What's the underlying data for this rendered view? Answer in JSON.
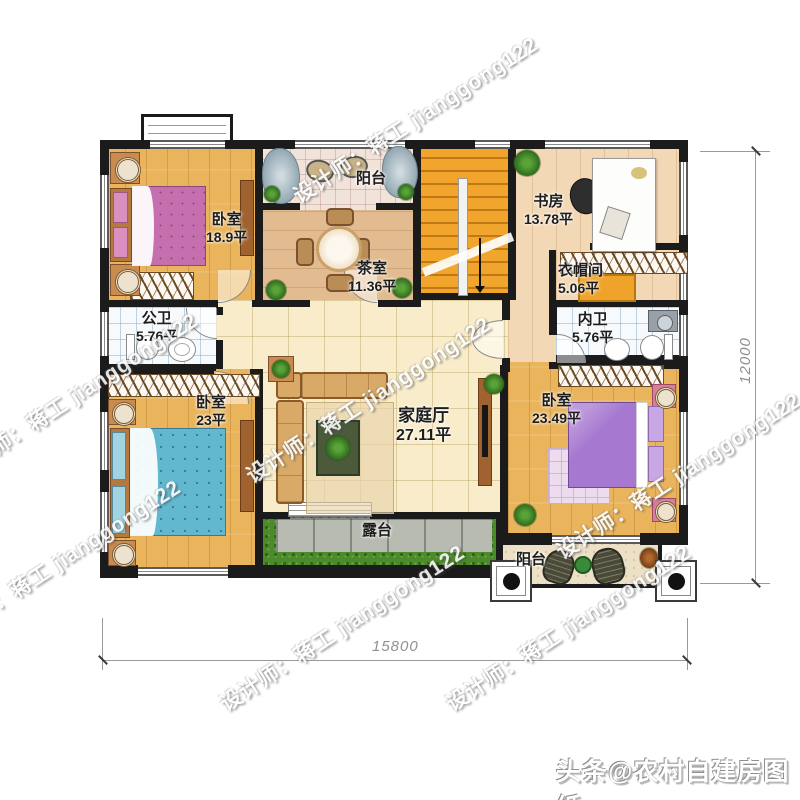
{
  "watermark": {
    "text": "设计师：蒋工 jianggong122"
  },
  "credit": {
    "text": "头条@农村自建房图纸"
  },
  "dimensions": {
    "width_label": "15800",
    "height_label": "12000"
  },
  "rooms": {
    "bedroom1": {
      "name": "卧室",
      "area": "18.9平"
    },
    "balcony_top": {
      "name": "阳台"
    },
    "tea_room": {
      "name": "茶室",
      "area": "11.36平"
    },
    "study": {
      "name": "书房",
      "area": "13.78平"
    },
    "cloakroom": {
      "name": "衣帽间",
      "area": "5.06平"
    },
    "bath_public": {
      "name": "公卫",
      "area": "5.76平"
    },
    "bath_private": {
      "name": "内卫",
      "area": "5.76平"
    },
    "bedroom2": {
      "name": "卧室",
      "area": "23平"
    },
    "family_hall": {
      "name": "家庭厅",
      "area": "27.11平"
    },
    "bedroom3": {
      "name": "卧室",
      "area": "23.49平"
    },
    "terrace": {
      "name": "露台"
    },
    "balcony_bottom": {
      "name": "阳台"
    }
  },
  "colors": {
    "wall": "#1b1b1b",
    "wood": "#e9b45c",
    "stairs": "#f2a52d",
    "hall_tile": "#f8ecca",
    "bed_pink": "#c56fae",
    "bed_blue": "#62b8cf",
    "bed_purple": "#a678d0",
    "grass": "#4d8a2c"
  }
}
